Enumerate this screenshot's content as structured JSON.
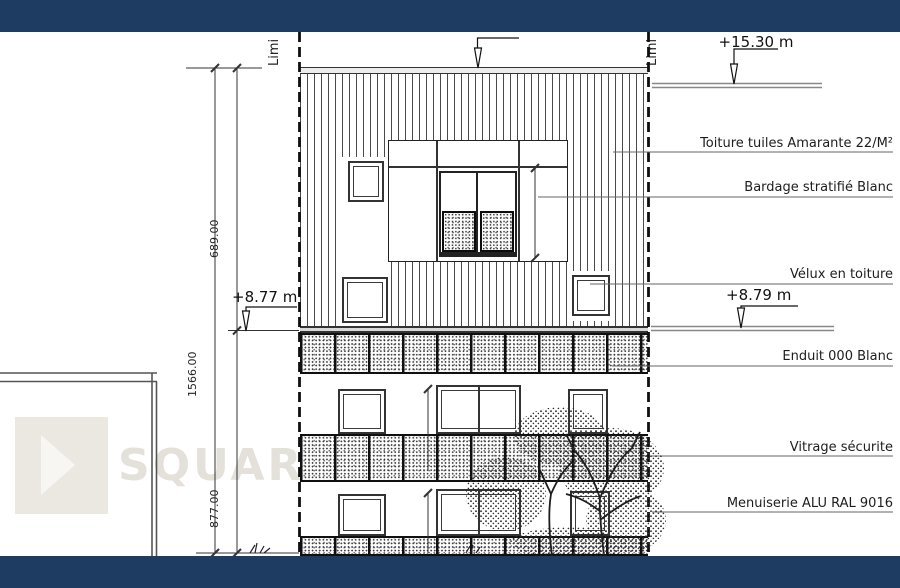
{
  "levels": {
    "ridge": "+15.30 m",
    "eave_left": "+8.77 m",
    "eave_right": "+8.79 m"
  },
  "limits": {
    "left": "Limi",
    "right": "Limi"
  },
  "annotations": [
    {
      "id": "toiture",
      "label": "Toiture tuiles Amarante 22/M²"
    },
    {
      "id": "bardage",
      "label": "Bardage stratifié Blanc"
    },
    {
      "id": "velux",
      "label": "Vélux en toiture"
    },
    {
      "id": "enduit",
      "label": "Enduit 000 Blanc"
    },
    {
      "id": "vitrage",
      "label": "Vitrage sécurite"
    },
    {
      "id": "menuiserie",
      "label": "Menuiserie ALU RAL 9016"
    }
  ],
  "dimensions": {
    "overall_height": "1566.00",
    "upper_height": "689.00",
    "lower_height": "877.00",
    "window_upper": "215.00",
    "window_middle": "215.00",
    "window_lower": "215.00"
  },
  "watermark": {
    "text": "SQUARE HABITAT"
  },
  "colors": {
    "bar_navy": "#1e3c61",
    "line_dark": "#1f1f1f",
    "line_gray": "#888888"
  }
}
